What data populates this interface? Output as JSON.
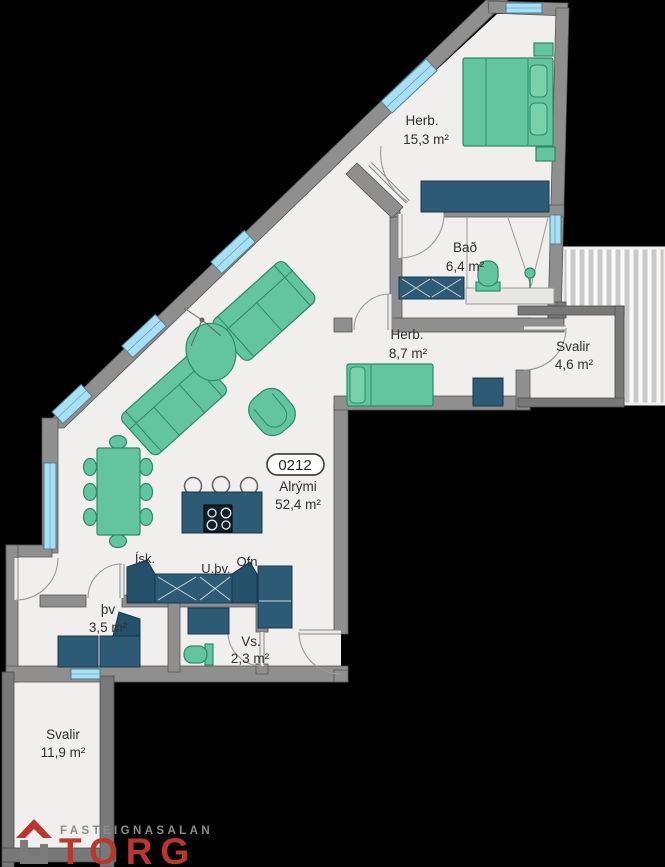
{
  "floor_plan": {
    "unit_badge": "0212",
    "rooms": [
      {
        "id": "herb1",
        "name": "Herb.",
        "area": "15,3 m²"
      },
      {
        "id": "bad",
        "name": "Bað",
        "area": "6,4 m²"
      },
      {
        "id": "herb2",
        "name": "Herb.",
        "area": "8,7 m²"
      },
      {
        "id": "svalir-east",
        "name": "Svalir",
        "area": "4,6 m²"
      },
      {
        "id": "alrymi",
        "name": "Alrými",
        "area": "52,4 m²"
      },
      {
        "id": "thv",
        "name": "þv",
        "area": "3,5 m²"
      },
      {
        "id": "vs",
        "name": "Vs.",
        "area": "2,3 m²"
      },
      {
        "id": "svalir-south",
        "name": "Svalir",
        "area": "11,9 m²"
      }
    ],
    "appliance_labels": {
      "fridge": "Ísk.",
      "dishwasher": "U.þv.",
      "oven": "Ofn"
    },
    "colors": {
      "background": "#000000",
      "floor": "#f0efed",
      "wall": "#8f8f8f",
      "furniture_green": "#63c4a0",
      "furniture_green_dark": "#2d8a67",
      "furniture_navy": "#2d5a74",
      "window_blue": "#a7e0f3",
      "logo_red": "#bb372b",
      "logo_grey": "#8c8c8c"
    }
  },
  "logo": {
    "tagline": "FASTEIGNASALAN",
    "brand": "TORG"
  }
}
